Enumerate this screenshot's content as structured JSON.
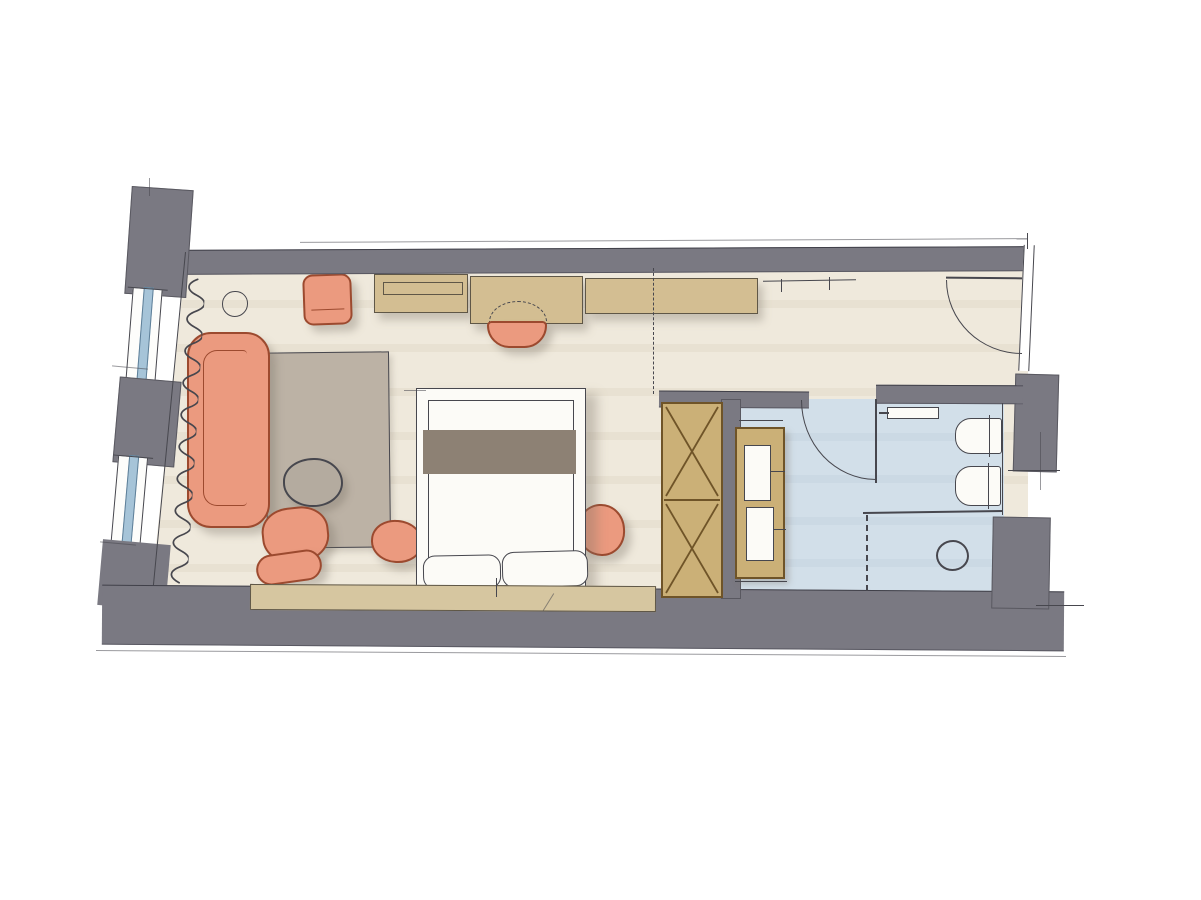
{
  "meta": {
    "description": "Hand-drawn watercolor floor plan sketch of a hotel guest room with living and sleeping area, entrance hallway, built-in wardrobe and bathroom. No text labels are rendered in the drawing."
  },
  "colors": {
    "background": "#FFFFFF",
    "wall_gray": "#7A7982",
    "pencil": "#47474E",
    "floor_cream": "#EFE9DC",
    "floor_cream_stripe": "#E8E1D2",
    "bathroom_blue": "#D2DFE9",
    "bathroom_blue_stripe": "#CBD9E4",
    "window_blue": "#A6C4D8",
    "window_frame_blue": "#5E7F98",
    "salmon": "#EB9A7F",
    "salmon_outline": "#9C4A2F",
    "tan": "#D3BE92",
    "wardrobe_tan": "#CBB077",
    "headboard_tan": "#D6C6A0",
    "wood_outline": "#6F5428",
    "rug_taupe": "#BCB2A5",
    "table_taupe": "#B4AB9F",
    "runner_taupe": "#8D8174",
    "fixture_white": "#FCFBF7",
    "shadow": "rgba(122,115,103,0.35)"
  },
  "rooms": {
    "living_sleeping": {
      "label": "Living / sleeping area"
    },
    "entrance": {
      "label": "Entrance hallway"
    },
    "bathroom": {
      "label": "Bathroom"
    }
  },
  "items": {
    "sideboard": {
      "label": "Sideboard / console"
    },
    "desk": {
      "label": "Writing desk"
    },
    "desk_stool": {
      "label": "Desk stool"
    },
    "lounge_chair": {
      "label": "Lounge chair"
    },
    "side_table": {
      "label": "Side table"
    },
    "sofa": {
      "label": "Sofa"
    },
    "rug": {
      "label": "Area rug"
    },
    "coffee_table": {
      "label": "Round coffee table"
    },
    "armchair": {
      "label": "Armchair"
    },
    "ottoman": {
      "label": "Ottoman"
    },
    "pouf": {
      "label": "Pouf"
    },
    "bedside_pouf": {
      "label": "Bedside pouf"
    },
    "bed": {
      "label": "Double bed"
    },
    "bed_runner": {
      "label": "Bed runner"
    },
    "pillow_left": {
      "label": "Pillow"
    },
    "pillow_right": {
      "label": "Pillow"
    },
    "headboard_panel": {
      "label": "Headboard panel"
    },
    "coat_rail": {
      "label": "Coat rail with hangers"
    },
    "wardrobe": {
      "label": "Built-in wardrobe"
    },
    "towel_shelf": {
      "label": "Towel shelf unit"
    },
    "entrance_door": {
      "label": "Entrance door"
    },
    "bathroom_door": {
      "label": "Bathroom door"
    },
    "wall_shelf": {
      "label": "Wall shelf"
    },
    "toilet": {
      "label": "Toilet"
    },
    "bidet": {
      "label": "Bidet"
    },
    "shower_partition": {
      "label": "Shower partition"
    },
    "glass_partition": {
      "label": "Glass partition (dashed)"
    },
    "floor_drain": {
      "label": "Shower floor drain"
    },
    "window_1": {
      "label": "Window"
    },
    "window_2": {
      "label": "Window"
    },
    "curtain": {
      "label": "Curtain"
    }
  }
}
